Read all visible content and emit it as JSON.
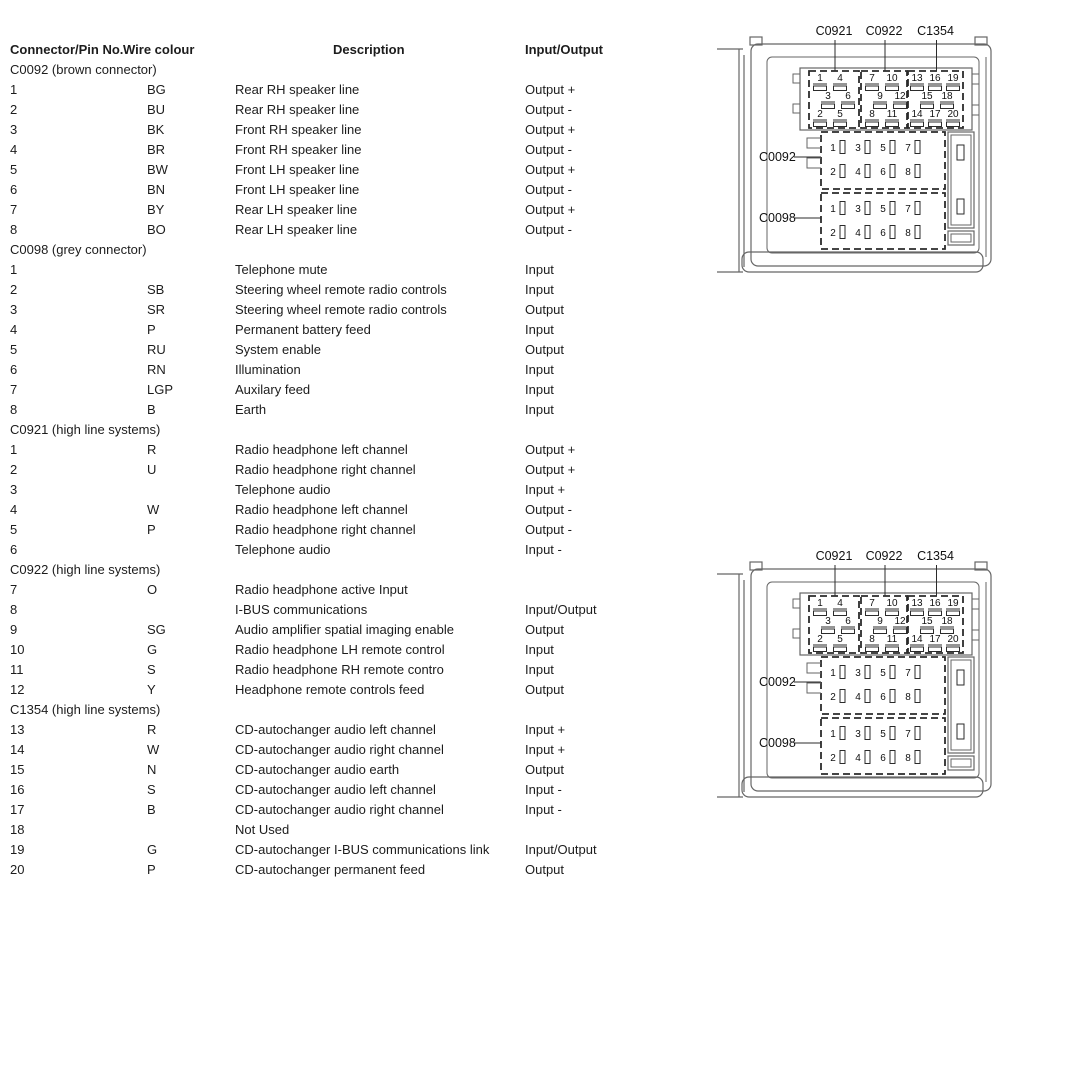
{
  "page": {
    "background": "#ffffff",
    "text_color": "#1c1c1c",
    "chassis_line_color": "#666666",
    "connector_line_color": "#2b2b2b"
  },
  "table": {
    "headers": {
      "connector_pin": "Connector/Pin No.",
      "wire_colour": "Wire colour",
      "description": "Description",
      "input_output": "Input/Output"
    },
    "sections": [
      {
        "title": "C0092 (brown connector)",
        "rows": [
          {
            "pin": "1",
            "wire": "BG",
            "description": "Rear RH speaker line",
            "io": "Output +"
          },
          {
            "pin": "2",
            "wire": "BU",
            "description": "Rear RH speaker line",
            "io": "Output -"
          },
          {
            "pin": "3",
            "wire": "BK",
            "description": "Front RH speaker line",
            "io": "Output +"
          },
          {
            "pin": "4",
            "wire": "BR",
            "description": "Front RH speaker line",
            "io": "Output -"
          },
          {
            "pin": "5",
            "wire": "BW",
            "description": "Front LH speaker line",
            "io": "Output +"
          },
          {
            "pin": "6",
            "wire": "BN",
            "description": "Front LH speaker line",
            "io": "Output -"
          },
          {
            "pin": "7",
            "wire": "BY",
            "description": "Rear LH speaker line",
            "io": "Output +"
          },
          {
            "pin": "8",
            "wire": "BO",
            "description": "Rear LH speaker line",
            "io": "Output -"
          }
        ]
      },
      {
        "title": "C0098 (grey connector)",
        "rows": [
          {
            "pin": "1",
            "wire": "",
            "description": "Telephone mute",
            "io": "Input"
          },
          {
            "pin": "2",
            "wire": "SB",
            "description": "Steering wheel remote radio controls",
            "io": "Input"
          },
          {
            "pin": "3",
            "wire": "SR",
            "description": "Steering wheel remote radio controls",
            "io": "Output"
          },
          {
            "pin": "4",
            "wire": "P",
            "description": "Permanent battery feed",
            "io": "Input"
          },
          {
            "pin": "5",
            "wire": "RU",
            "description": "System enable",
            "io": "Output"
          },
          {
            "pin": "6",
            "wire": "RN",
            "description": "Illumination",
            "io": "Input"
          },
          {
            "pin": "7",
            "wire": "LGP",
            "description": "Auxilary feed",
            "io": "Input"
          },
          {
            "pin": "8",
            "wire": "B",
            "description": "Earth",
            "io": "Input"
          }
        ]
      },
      {
        "title": "C0921 (high line systems)",
        "rows": [
          {
            "pin": "1",
            "wire": "R",
            "description": "Radio headphone left channel",
            "io": "Output +"
          },
          {
            "pin": "2",
            "wire": "U",
            "description": "Radio headphone right channel",
            "io": "Output +"
          },
          {
            "pin": "3",
            "wire": "",
            "description": "Telephone audio",
            "io": "Input +"
          },
          {
            "pin": "4",
            "wire": "W",
            "description": "Radio headphone left channel",
            "io": "Output -"
          },
          {
            "pin": "5",
            "wire": "P",
            "description": "Radio headphone right channel",
            "io": "Output -"
          },
          {
            "pin": "6",
            "wire": "",
            "description": "Telephone audio",
            "io": "Input -"
          }
        ]
      },
      {
        "title": "C0922 (high line systems)",
        "rows": [
          {
            "pin": "7",
            "wire": "O",
            "description": "Radio headphone active Input",
            "io": ""
          },
          {
            "pin": "8",
            "wire": "",
            "description": "I-BUS communications",
            "io": "Input/Output"
          },
          {
            "pin": "9",
            "wire": "SG",
            "description": "Audio amplifier spatial imaging enable",
            "io": "Output"
          },
          {
            "pin": "10",
            "wire": "G",
            "description": "Radio headphone LH remote control",
            "io": "Input"
          },
          {
            "pin": "11",
            "wire": "S",
            "description": "Radio headphone RH remote contro",
            "io": "Input"
          },
          {
            "pin": "12",
            "wire": "Y",
            "description": "Headphone remote controls feed",
            "io": "Output"
          }
        ]
      },
      {
        "title": "C1354 (high line systems)",
        "rows": [
          {
            "pin": "13",
            "wire": "R",
            "description": "CD-autochanger audio left channel",
            "io": "Input +"
          },
          {
            "pin": "14",
            "wire": "W",
            "description": "CD-autochanger audio right channel",
            "io": "Input +"
          },
          {
            "pin": "15",
            "wire": "N",
            "description": "CD-autochanger audio earth",
            "io": "Output"
          },
          {
            "pin": "16",
            "wire": "S",
            "description": "CD-autochanger audio left channel",
            "io": "Input -"
          },
          {
            "pin": "17",
            "wire": "B",
            "description": "CD-autochanger audio right channel",
            "io": "Input -"
          },
          {
            "pin": "18",
            "wire": "",
            "description": "Not Used",
            "io": ""
          },
          {
            "pin": "19",
            "wire": "G",
            "description": "CD-autochanger I-BUS communications link",
            "io": "Input/Output"
          },
          {
            "pin": "20",
            "wire": "P",
            "description": "CD-autochanger permanent feed",
            "io": "Output"
          }
        ]
      }
    ]
  },
  "diagram": {
    "instances": [
      "top",
      "bottom"
    ],
    "top_connectors": [
      {
        "label": "C0921",
        "pin_rows": [
          [
            "1",
            "4"
          ],
          [
            "3",
            "6"
          ],
          [
            "2",
            "5"
          ]
        ]
      },
      {
        "label": "C0922",
        "pin_rows": [
          [
            "7",
            "10"
          ],
          [
            "9",
            "12"
          ],
          [
            "8",
            "11"
          ]
        ]
      },
      {
        "label": "C1354",
        "pin_rows": [
          [
            "13",
            "16",
            "19"
          ],
          [
            "15",
            "18"
          ],
          [
            "14",
            "17",
            "20"
          ]
        ]
      }
    ],
    "side_connectors": [
      {
        "label": "C0092",
        "pin_rows": [
          [
            "1",
            "3",
            "5",
            "7"
          ],
          [
            "2",
            "4",
            "6",
            "8"
          ]
        ]
      },
      {
        "label": "C0098",
        "pin_rows": [
          [
            "1",
            "3",
            "5",
            "7"
          ],
          [
            "2",
            "4",
            "6",
            "8"
          ]
        ]
      }
    ]
  }
}
